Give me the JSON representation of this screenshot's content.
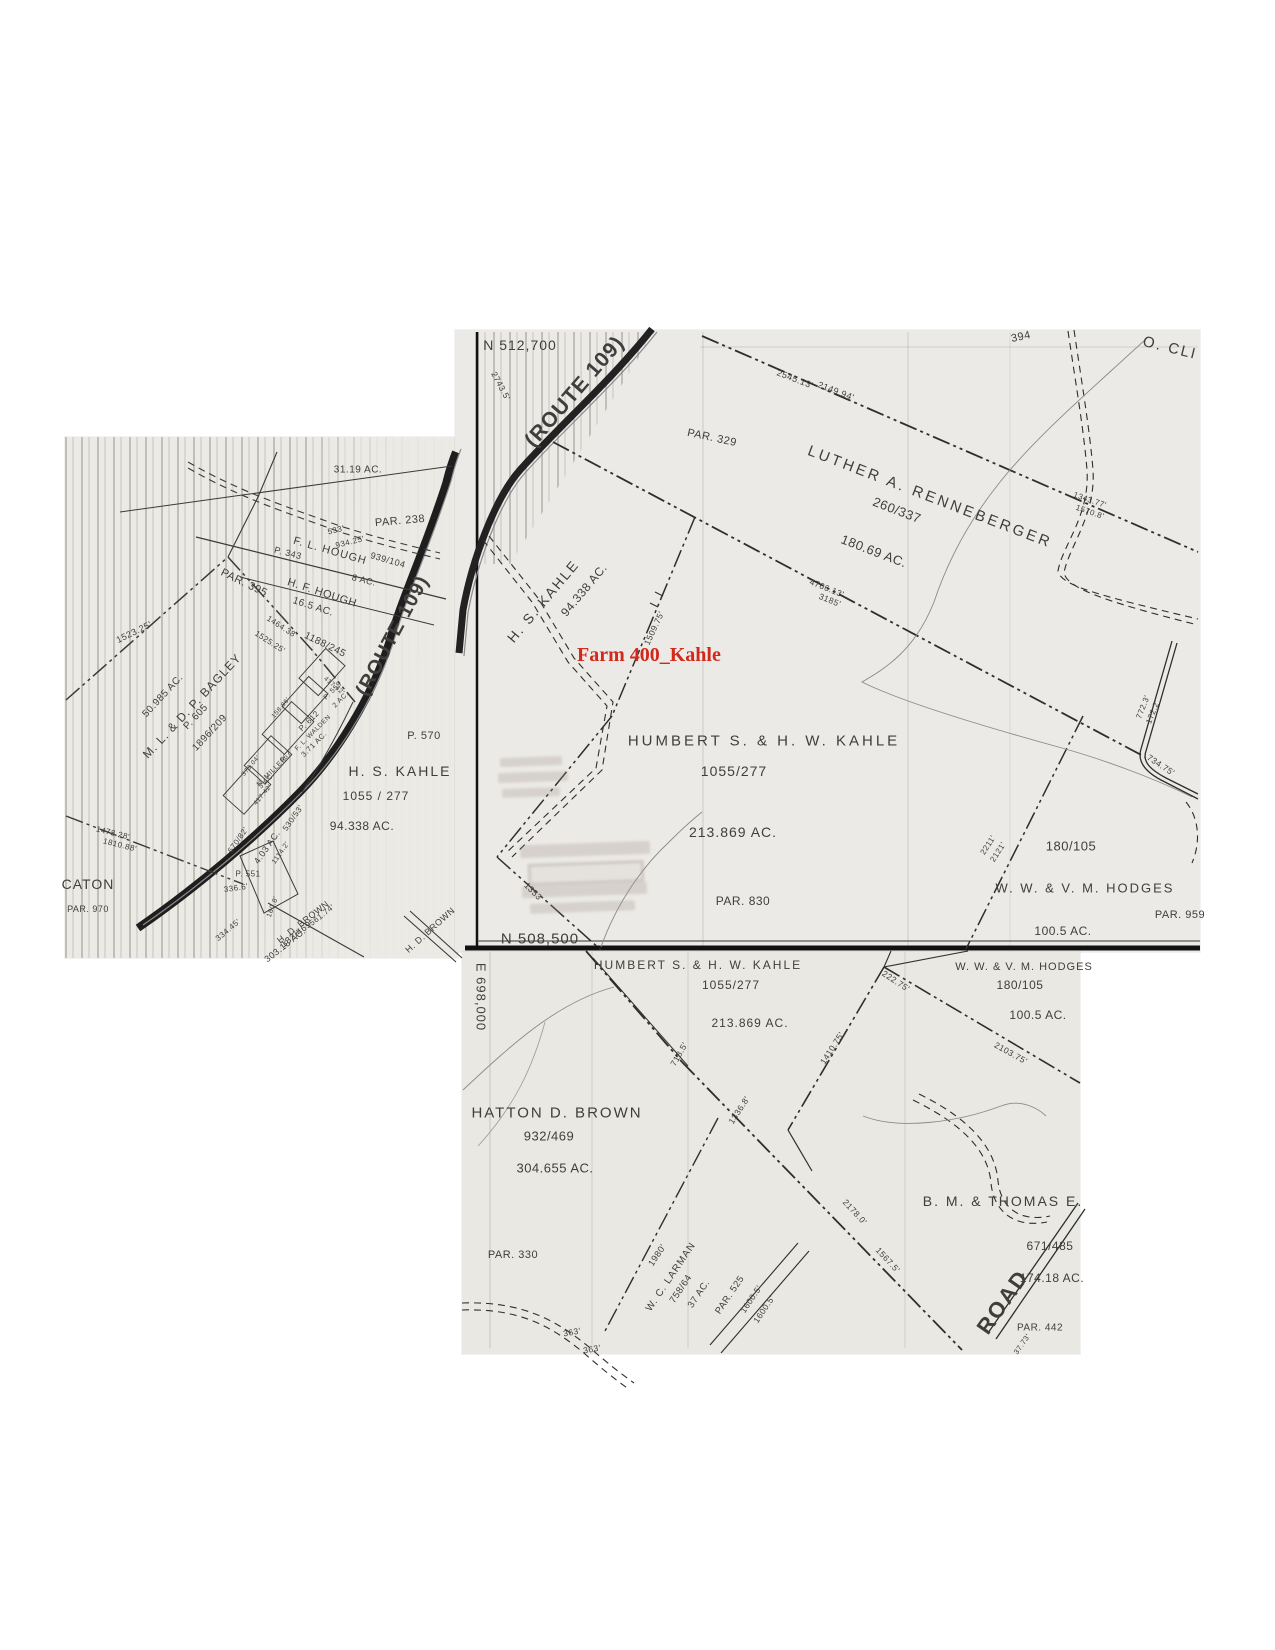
{
  "colors": {
    "paper": "#ebeae5",
    "ink": "#3f3e3c",
    "red_accent": "#d2291b",
    "road_ink": "#1e1e1e"
  },
  "red_overlay": {
    "text": "Farm 400_Kahle",
    "color": "#d2291b"
  },
  "maps": [
    {
      "name": "left-sheet",
      "labels": [
        {
          "t": "31.19 AC.",
          "x": 358,
          "y": 470,
          "r": 0,
          "s": 10
        },
        {
          "t": "PAR. 238",
          "x": 400,
          "y": 521,
          "r": -5,
          "s": 11
        },
        {
          "t": "533'",
          "x": 336,
          "y": 530,
          "r": -14,
          "s": 8
        },
        {
          "t": "934.25'",
          "x": 350,
          "y": 542,
          "r": -14,
          "s": 8
        },
        {
          "t": "F. L. HOUGH",
          "x": 330,
          "y": 551,
          "r": 16,
          "s": 11,
          "sp": 1
        },
        {
          "t": "939/104",
          "x": 388,
          "y": 560,
          "r": 16,
          "s": 9
        },
        {
          "t": "P. 343",
          "x": 288,
          "y": 553,
          "r": 14,
          "s": 9
        },
        {
          "t": "8 AC.",
          "x": 364,
          "y": 580,
          "r": 14,
          "s": 9
        },
        {
          "t": "H. F. HOUGH",
          "x": 322,
          "y": 593,
          "r": 18,
          "s": 11
        },
        {
          "t": "16.5 AC.",
          "x": 313,
          "y": 607,
          "r": 18,
          "s": 10
        },
        {
          "t": "1188/245",
          "x": 325,
          "y": 645,
          "r": 26,
          "s": 10
        },
        {
          "t": "PAR. 395",
          "x": 244,
          "y": 583,
          "r": 26,
          "s": 11
        },
        {
          "t": "1523.25'",
          "x": 134,
          "y": 632,
          "r": -26,
          "s": 9
        },
        {
          "t": "1464.38'",
          "x": 282,
          "y": 627,
          "r": 33,
          "s": 8
        },
        {
          "t": "1525.25'",
          "x": 270,
          "y": 642,
          "r": 33,
          "s": 8
        },
        {
          "t": "(ROUTE 109)",
          "x": 393,
          "y": 636,
          "r": -62,
          "s": 20,
          "b": 1,
          "sp": 1
        },
        {
          "t": "M. L. & D. P. BAGLEY",
          "x": 192,
          "y": 706,
          "r": -47,
          "s": 12,
          "sp": 1
        },
        {
          "t": "50.985 AC.",
          "x": 163,
          "y": 696,
          "r": -47,
          "s": 10
        },
        {
          "t": "P. 605",
          "x": 196,
          "y": 717,
          "r": -47,
          "s": 10
        },
        {
          "t": "1896/209",
          "x": 210,
          "y": 733,
          "r": -47,
          "s": 10
        },
        {
          "t": "P. 559",
          "x": 333,
          "y": 691,
          "r": -45,
          "s": 7
        },
        {
          "t": "2 AC.",
          "x": 341,
          "y": 700,
          "r": -45,
          "s": 7
        },
        {
          "t": "P. 612",
          "x": 309,
          "y": 721,
          "r": -45,
          "s": 8
        },
        {
          "t": "F. L. WALDEN",
          "x": 313,
          "y": 733,
          "r": -45,
          "s": 6.5
        },
        {
          "t": "3.71 AC.",
          "x": 314,
          "y": 744,
          "r": -45,
          "s": 7.5
        },
        {
          "t": "667",
          "x": 286,
          "y": 757,
          "r": -45,
          "s": 7
        },
        {
          "t": "N. MILLER",
          "x": 272,
          "y": 772,
          "r": -45,
          "s": 7
        },
        {
          "t": "3 AC.",
          "x": 267,
          "y": 781,
          "r": -45,
          "s": 7
        },
        {
          "t": "158.86'",
          "x": 281,
          "y": 708,
          "r": -50,
          "s": 6.5
        },
        {
          "t": "417.42'",
          "x": 334,
          "y": 686,
          "r": 40,
          "s": 6.5
        },
        {
          "t": "373.04'",
          "x": 251,
          "y": 766,
          "r": -50,
          "s": 6.5
        },
        {
          "t": "417.42'",
          "x": 263,
          "y": 795,
          "r": -50,
          "s": 6.5
        },
        {
          "t": "P. 570",
          "x": 424,
          "y": 736,
          "r": 0,
          "s": 11
        },
        {
          "t": "H. S. KAHLE",
          "x": 400,
          "y": 771,
          "r": 0,
          "s": 14,
          "sp": 2
        },
        {
          "t": "1055 / 277",
          "x": 376,
          "y": 796,
          "r": 0,
          "s": 12,
          "sp": 1
        },
        {
          "t": "94.338 AC.",
          "x": 362,
          "y": 826,
          "r": 0,
          "s": 12
        },
        {
          "t": "670/82'",
          "x": 238,
          "y": 840,
          "r": -55,
          "s": 8
        },
        {
          "t": "4.03 AC.",
          "x": 267,
          "y": 847,
          "r": -55,
          "s": 9
        },
        {
          "t": "530/53'",
          "x": 293,
          "y": 818,
          "r": -55,
          "s": 8
        },
        {
          "t": "1114.2'",
          "x": 281,
          "y": 853,
          "r": -55,
          "s": 7
        },
        {
          "t": "1478.28'",
          "x": 113,
          "y": 833,
          "r": 14,
          "s": 8
        },
        {
          "t": "1810.88'",
          "x": 120,
          "y": 845,
          "r": 14,
          "s": 8
        },
        {
          "t": "CATON",
          "x": 88,
          "y": 884,
          "r": 0,
          "s": 14,
          "sp": 1
        },
        {
          "t": "P. 551",
          "x": 248,
          "y": 874,
          "r": 0,
          "s": 8
        },
        {
          "t": "336.6'",
          "x": 236,
          "y": 888,
          "r": -8,
          "s": 8
        },
        {
          "t": "160.8'",
          "x": 273,
          "y": 907,
          "r": -70,
          "s": 7
        },
        {
          "t": "561.74'",
          "x": 322,
          "y": 915,
          "r": -38,
          "s": 8
        },
        {
          "t": "H. D. BROWN",
          "x": 303,
          "y": 922,
          "r": -38,
          "s": 9
        },
        {
          "t": "132/469",
          "x": 296,
          "y": 934,
          "r": -38,
          "s": 9
        },
        {
          "t": "303.18 AC.",
          "x": 285,
          "y": 945,
          "r": -38,
          "s": 9
        },
        {
          "t": "334.45'",
          "x": 228,
          "y": 930,
          "r": -40,
          "s": 8
        },
        {
          "t": "PAR. 970",
          "x": 88,
          "y": 909,
          "r": 0,
          "s": 9
        },
        {
          "t": "H. D. BROWN",
          "x": 430,
          "y": 930,
          "r": -42,
          "s": 9
        }
      ]
    },
    {
      "name": "top-sheet",
      "labels": [
        {
          "t": "N 512,700",
          "x": 520,
          "y": 345,
          "r": 0,
          "s": 14,
          "sp": 1
        },
        {
          "t": "(ROUTE 109)",
          "x": 575,
          "y": 392,
          "r": -49,
          "s": 21,
          "b": 1,
          "sp": 1
        },
        {
          "t": "2743.5'",
          "x": 501,
          "y": 386,
          "r": 62,
          "s": 8.5
        },
        {
          "t": "2545.13'",
          "x": 795,
          "y": 379,
          "r": 21,
          "s": 9
        },
        {
          "t": "2149.94'",
          "x": 836,
          "y": 391,
          "r": 21,
          "s": 9
        },
        {
          "t": "394",
          "x": 1021,
          "y": 337,
          "r": -12,
          "s": 11
        },
        {
          "t": "O. CLI",
          "x": 1170,
          "y": 348,
          "r": 14,
          "s": 15,
          "sp": 2
        },
        {
          "t": "PAR. 329",
          "x": 712,
          "y": 438,
          "r": 12,
          "s": 11
        },
        {
          "t": "LUTHER A. RENNEBERGER",
          "x": 930,
          "y": 497,
          "r": 21,
          "s": 15,
          "sp": 3
        },
        {
          "t": "260/337",
          "x": 897,
          "y": 510,
          "r": 21,
          "s": 13
        },
        {
          "t": "180.69 AC.",
          "x": 874,
          "y": 551,
          "r": 21,
          "s": 13
        },
        {
          "t": "1343.77'",
          "x": 1090,
          "y": 500,
          "r": 19,
          "s": 8
        },
        {
          "t": "1570.8'",
          "x": 1090,
          "y": 512,
          "r": 19,
          "s": 8
        },
        {
          "t": "H. S. KAHLE",
          "x": 543,
          "y": 601,
          "r": -50,
          "s": 14,
          "sp": 2
        },
        {
          "t": "94.338 AC.",
          "x": 584,
          "y": 590,
          "r": -50,
          "s": 12
        },
        {
          "t": "4706.13'",
          "x": 827,
          "y": 588,
          "r": 22,
          "s": 8.5
        },
        {
          "t": "3185'",
          "x": 830,
          "y": 600,
          "r": 22,
          "s": 8.5
        },
        {
          "t": "1509.75'",
          "x": 654,
          "y": 628,
          "r": -65,
          "s": 8.5
        },
        {
          "t": "HUMBERT S. & H. W. KAHLE",
          "x": 764,
          "y": 741,
          "r": 0,
          "s": 15,
          "sp": 3
        },
        {
          "t": "1055/277",
          "x": 734,
          "y": 771,
          "r": 0,
          "s": 14,
          "sp": 1
        },
        {
          "t": "213.869 AC.",
          "x": 733,
          "y": 832,
          "r": 0,
          "s": 14,
          "sp": 1
        },
        {
          "t": "PAR. 830",
          "x": 743,
          "y": 901,
          "r": 0,
          "s": 12
        },
        {
          "t": "772.3'",
          "x": 1143,
          "y": 707,
          "r": -68,
          "s": 8
        },
        {
          "t": "172.2'",
          "x": 1153,
          "y": 712,
          "r": -68,
          "s": 8
        },
        {
          "t": "734.75'",
          "x": 1161,
          "y": 765,
          "r": 33,
          "s": 8.5
        },
        {
          "t": "2211'",
          "x": 988,
          "y": 845,
          "r": -57,
          "s": 8
        },
        {
          "t": "2121'",
          "x": 998,
          "y": 852,
          "r": -57,
          "s": 8
        },
        {
          "t": "180/105",
          "x": 1071,
          "y": 846,
          "r": 0,
          "s": 13
        },
        {
          "t": "W. W. & V. M. HODGES",
          "x": 1085,
          "y": 888,
          "r": 0,
          "s": 13,
          "sp": 2
        },
        {
          "t": "100.5 AC.",
          "x": 1063,
          "y": 931,
          "r": 0,
          "s": 12
        },
        {
          "t": "PAR. 959",
          "x": 1180,
          "y": 915,
          "r": 0,
          "s": 11
        },
        {
          "t": "N 508,500",
          "x": 540,
          "y": 939,
          "r": 0,
          "s": 15,
          "sp": 1
        },
        {
          "t": "1353'",
          "x": 534,
          "y": 892,
          "r": 45,
          "s": 8.5
        }
      ]
    },
    {
      "name": "bottom-sheet",
      "labels": [
        {
          "t": "E 698,000",
          "x": 481,
          "y": 997,
          "r": 90,
          "s": 13,
          "sp": 1
        },
        {
          "t": "HUMBERT S. & H. W. KAHLE",
          "x": 698,
          "y": 965,
          "r": 0,
          "s": 12,
          "sp": 2
        },
        {
          "t": "1055/277",
          "x": 731,
          "y": 985,
          "r": 0,
          "s": 12,
          "sp": 1
        },
        {
          "t": "213.869 AC.",
          "x": 750,
          "y": 1023,
          "r": 0,
          "s": 12,
          "sp": 1
        },
        {
          "t": "W. W. & V. M. HODGES",
          "x": 1024,
          "y": 967,
          "r": 0,
          "s": 11,
          "sp": 1
        },
        {
          "t": "180/105",
          "x": 1020,
          "y": 985,
          "r": 0,
          "s": 12
        },
        {
          "t": "100.5 AC.",
          "x": 1038,
          "y": 1015,
          "r": 0,
          "s": 12
        },
        {
          "t": "222.75'",
          "x": 896,
          "y": 981,
          "r": 33,
          "s": 8.5
        },
        {
          "t": "1410.75'",
          "x": 832,
          "y": 1048,
          "r": -57,
          "s": 8.5
        },
        {
          "t": "2103.75'",
          "x": 1011,
          "y": 1053,
          "r": 29,
          "s": 8.5
        },
        {
          "t": "718.5'",
          "x": 679,
          "y": 1054,
          "r": -60,
          "s": 8.5
        },
        {
          "t": "1336.8'",
          "x": 739,
          "y": 1110,
          "r": -57,
          "s": 8.5
        },
        {
          "t": "HATTON D. BROWN",
          "x": 557,
          "y": 1113,
          "r": 0,
          "s": 15,
          "sp": 2
        },
        {
          "t": "932/469",
          "x": 549,
          "y": 1136,
          "r": 0,
          "s": 13
        },
        {
          "t": "304.655 AC.",
          "x": 555,
          "y": 1168,
          "r": 0,
          "s": 13
        },
        {
          "t": "PAR. 330",
          "x": 513,
          "y": 1255,
          "r": 0,
          "s": 11
        },
        {
          "t": "1980'",
          "x": 657,
          "y": 1255,
          "r": -56,
          "s": 9
        },
        {
          "t": "W. C. LARMAN",
          "x": 671,
          "y": 1277,
          "r": -56,
          "s": 10,
          "sp": 1
        },
        {
          "t": "758/64",
          "x": 681,
          "y": 1289,
          "r": -56,
          "s": 9.5
        },
        {
          "t": "37 AC.",
          "x": 699,
          "y": 1294,
          "r": -56,
          "s": 9.5
        },
        {
          "t": "PAR. 525",
          "x": 730,
          "y": 1295,
          "r": -56,
          "s": 9.5
        },
        {
          "t": "1600.5'",
          "x": 751,
          "y": 1299,
          "r": -56,
          "s": 8.5
        },
        {
          "t": "1600.5'",
          "x": 764,
          "y": 1309,
          "r": -56,
          "s": 8.5
        },
        {
          "t": "1567.5'",
          "x": 888,
          "y": 1260,
          "r": 47,
          "s": 8.5
        },
        {
          "t": "2178.0'",
          "x": 855,
          "y": 1212,
          "r": 47,
          "s": 8.5
        },
        {
          "t": "B. M. & THOMAS E.",
          "x": 1003,
          "y": 1201,
          "r": 0,
          "s": 14,
          "sp": 2
        },
        {
          "t": "671/485",
          "x": 1050,
          "y": 1246,
          "r": 0,
          "s": 12
        },
        {
          "t": "174.18 AC.",
          "x": 1052,
          "y": 1278,
          "r": 0,
          "s": 12
        },
        {
          "t": "ROAD",
          "x": 1003,
          "y": 1302,
          "r": -55,
          "s": 22,
          "b": 1,
          "sp": 2
        },
        {
          "t": "PAR. 442",
          "x": 1040,
          "y": 1328,
          "r": 0,
          "s": 10
        },
        {
          "t": "363'",
          "x": 572,
          "y": 1332,
          "r": -10,
          "s": 8.5
        },
        {
          "t": "363'",
          "x": 592,
          "y": 1349,
          "r": -10,
          "s": 8.5
        },
        {
          "t": "37.73'",
          "x": 1022,
          "y": 1344,
          "r": -55,
          "s": 7.5
        }
      ]
    }
  ]
}
